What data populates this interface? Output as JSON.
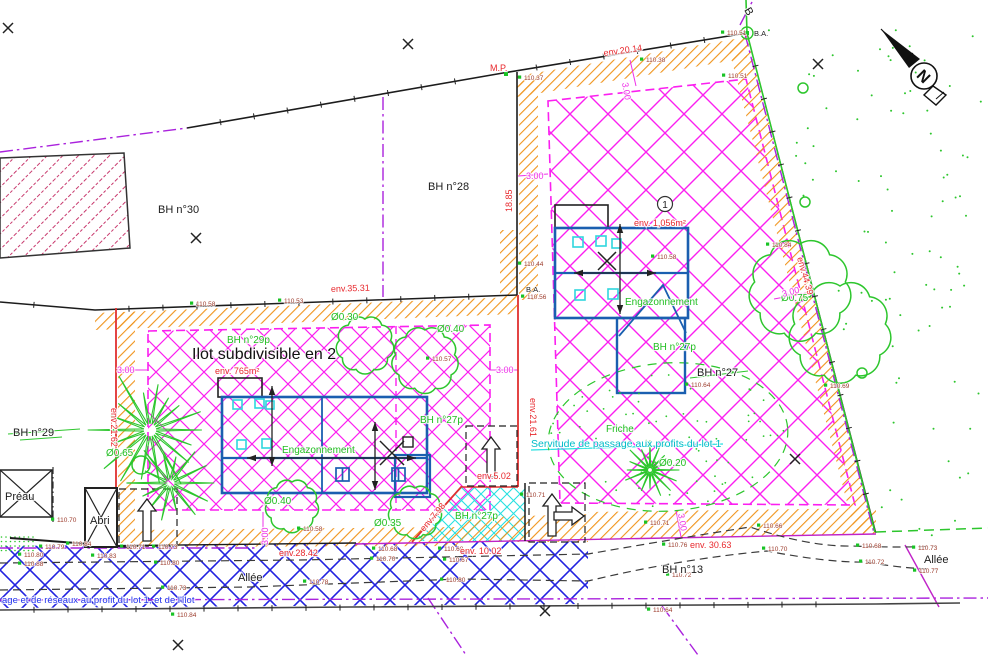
{
  "ilot": {
    "title": "Ilot subdivisible en 2"
  },
  "lot1": {
    "number": "1"
  },
  "north": {
    "letter": "N"
  },
  "colors": {
    "zone_magenta": "#FB1FF0",
    "alley_blue": "#2222E0",
    "vegetation_green": "#2DC62D",
    "boundary_orange": "#F0941C",
    "dimension_red": "#E8282D",
    "servitude_cyan": "#00BCC8",
    "building_blue": "#1A5FB0",
    "cadastral_purple": "#AA22DD",
    "bh30_hatch": "#C2245E",
    "point_label_brown": "#9C3B2B"
  },
  "labels_black": [
    {
      "t": "BH n°30",
      "x": 158,
      "y": 213,
      "s": 11
    },
    {
      "t": "BH n°28",
      "x": 428,
      "y": 190,
      "s": 11
    },
    {
      "t": "BH n°29",
      "x": 13,
      "y": 436,
      "s": 11
    },
    {
      "t": "BH n°27",
      "x": 697,
      "y": 376,
      "s": 11
    },
    {
      "t": "BH n°13",
      "x": 662,
      "y": 573,
      "s": 11
    },
    {
      "t": "Allée",
      "x": 238,
      "y": 581,
      "s": 11
    },
    {
      "t": "Allée",
      "x": 924,
      "y": 563,
      "s": 12
    },
    {
      "t": "Préau",
      "x": 5,
      "y": 500,
      "s": 11
    },
    {
      "t": "Abri",
      "x": 90,
      "y": 524,
      "s": 10
    },
    {
      "t": "B",
      "x": 744,
      "y": 10,
      "s": 9,
      "r": 60
    }
  ],
  "labels_green": [
    {
      "t": "BH n°29p",
      "x": 227,
      "y": 343
    },
    {
      "t": "BH n°27p",
      "x": 420,
      "y": 423
    },
    {
      "t": "BH n°27p",
      "x": 455,
      "y": 519
    },
    {
      "t": "BH n°27p",
      "x": 653,
      "y": 350
    },
    {
      "t": "Engazonnement",
      "x": 282,
      "y": 453
    },
    {
      "t": "Engazonnement",
      "x": 625,
      "y": 305
    },
    {
      "t": "Friche",
      "x": 606,
      "y": 432
    },
    {
      "t": "Ø0.30",
      "x": 331,
      "y": 320
    },
    {
      "t": "Ø0.40",
      "x": 437,
      "y": 332
    },
    {
      "t": "Ø0.40",
      "x": 264,
      "y": 504
    },
    {
      "t": "Ø0.35",
      "x": 374,
      "y": 526
    },
    {
      "t": "Ø0.65",
      "x": 106,
      "y": 456
    },
    {
      "t": "Ø0.75",
      "x": 781,
      "y": 301
    },
    {
      "t": "Ø0.20",
      "x": 659,
      "y": 466
    }
  ],
  "labels_red": [
    {
      "t": "env.20.14",
      "x": 604,
      "y": 56,
      "r": -8
    },
    {
      "t": "env.35.31",
      "x": 331,
      "y": 292,
      "r": -2
    },
    {
      "t": "env.28.42",
      "x": 279,
      "y": 556
    },
    {
      "t": "env. 30.63",
      "x": 690,
      "y": 548
    },
    {
      "t": "env. 10.02",
      "x": 460,
      "y": 554
    },
    {
      "t": "env.44.39",
      "x": 797,
      "y": 258,
      "r": 74
    },
    {
      "t": "env.21.61",
      "x": 530,
      "y": 398,
      "r": 90
    },
    {
      "t": "env.21.62",
      "x": 111,
      "y": 408,
      "r": 90
    },
    {
      "t": "env.5.02",
      "x": 477,
      "y": 479
    },
    {
      "t": "18.85",
      "x": 512,
      "y": 212,
      "r": -90
    },
    {
      "t": "M.P.",
      "x": 490,
      "y": 71
    },
    {
      "t": "env.7.98",
      "x": 424,
      "y": 532,
      "r": -50
    },
    {
      "t": "env. 765m²",
      "x": 215,
      "y": 374,
      "s": 11
    },
    {
      "t": "env. 1,056m²",
      "x": 634,
      "y": 226,
      "s": 11
    }
  ],
  "labels_magenta": [
    {
      "t": "3.00",
      "x": 622,
      "y": 83,
      "r": 80
    },
    {
      "t": "3.00",
      "x": 526,
      "y": 179
    },
    {
      "t": "3.00",
      "x": 117,
      "y": 373
    },
    {
      "t": "3.00",
      "x": 496,
      "y": 373
    },
    {
      "t": "3.00",
      "x": 268,
      "y": 545,
      "r": -90
    },
    {
      "t": "3.00",
      "x": 783,
      "y": 297,
      "r": -15
    },
    {
      "t": "3.00",
      "x": 678,
      "y": 514,
      "r": 80
    }
  ],
  "labels_cyan": [
    {
      "t": "Servitude de passage aux profits du lot 1",
      "x": 531,
      "y": 447
    }
  ],
  "labels_blue": [
    {
      "t": "age et de réseaux au profit du lot 1, et de l'îlot",
      "x": 2,
      "y": 603
    }
  ],
  "labels_ba": [
    {
      "t": "B.A.",
      "x": 754,
      "y": 36
    },
    {
      "t": "B.A.",
      "x": 526,
      "y": 292
    }
  ],
  "labels_points": [
    {
      "t": "110.37",
      "x": 524,
      "y": 80
    },
    {
      "t": "110.38",
      "x": 646,
      "y": 62
    },
    {
      "t": "110.51",
      "x": 727,
      "y": 35
    },
    {
      "t": "110.51",
      "x": 728,
      "y": 78
    },
    {
      "t": "110.44",
      "x": 524,
      "y": 266
    },
    {
      "t": "110.56",
      "x": 527,
      "y": 299
    },
    {
      "t": "110.58",
      "x": 196,
      "y": 306
    },
    {
      "t": "110.53",
      "x": 284,
      "y": 303
    },
    {
      "t": "110.57",
      "x": 432,
      "y": 361
    },
    {
      "t": "110.58",
      "x": 657,
      "y": 259
    },
    {
      "t": "110.84",
      "x": 772,
      "y": 247
    },
    {
      "t": "110.69",
      "x": 830,
      "y": 388
    },
    {
      "t": "110.64",
      "x": 691,
      "y": 387
    },
    {
      "t": "110.70",
      "x": 57,
      "y": 522
    },
    {
      "t": "110.79",
      "x": 45,
      "y": 549
    },
    {
      "t": "110.84",
      "x": 72,
      "y": 546
    },
    {
      "t": "110.80",
      "x": 24,
      "y": 557
    },
    {
      "t": "110.88",
      "x": 24,
      "y": 566
    },
    {
      "t": "110.83",
      "x": 97,
      "y": 558
    },
    {
      "t": "110.71",
      "x": 126,
      "y": 549
    },
    {
      "t": "110.73",
      "x": 158,
      "y": 549
    },
    {
      "t": "110.80",
      "x": 160,
      "y": 565
    },
    {
      "t": "110.73",
      "x": 167,
      "y": 590
    },
    {
      "t": "110.84",
      "x": 177,
      "y": 617
    },
    {
      "t": "110.58",
      "x": 303,
      "y": 531
    },
    {
      "t": "110.68",
      "x": 378,
      "y": 551
    },
    {
      "t": "110.70",
      "x": 376,
      "y": 561
    },
    {
      "t": "110.78",
      "x": 309,
      "y": 584
    },
    {
      "t": "110.68",
      "x": 444,
      "y": 551
    },
    {
      "t": "110.67",
      "x": 449,
      "y": 562
    },
    {
      "t": "110.80",
      "x": 446,
      "y": 582
    },
    {
      "t": "110.71",
      "x": 526,
      "y": 497
    },
    {
      "t": "110.71",
      "x": 650,
      "y": 525
    },
    {
      "t": "110.66",
      "x": 763,
      "y": 528
    },
    {
      "t": "110.76",
      "x": 668,
      "y": 547
    },
    {
      "t": "110.70",
      "x": 768,
      "y": 551
    },
    {
      "t": "110.72",
      "x": 672,
      "y": 577
    },
    {
      "t": "110.68",
      "x": 862,
      "y": 548
    },
    {
      "t": "110.73",
      "x": 918,
      "y": 550
    },
    {
      "t": "110.72",
      "x": 865,
      "y": 564
    },
    {
      "t": "110.77",
      "x": 919,
      "y": 573
    },
    {
      "t": "110.64",
      "x": 653,
      "y": 612
    }
  ]
}
